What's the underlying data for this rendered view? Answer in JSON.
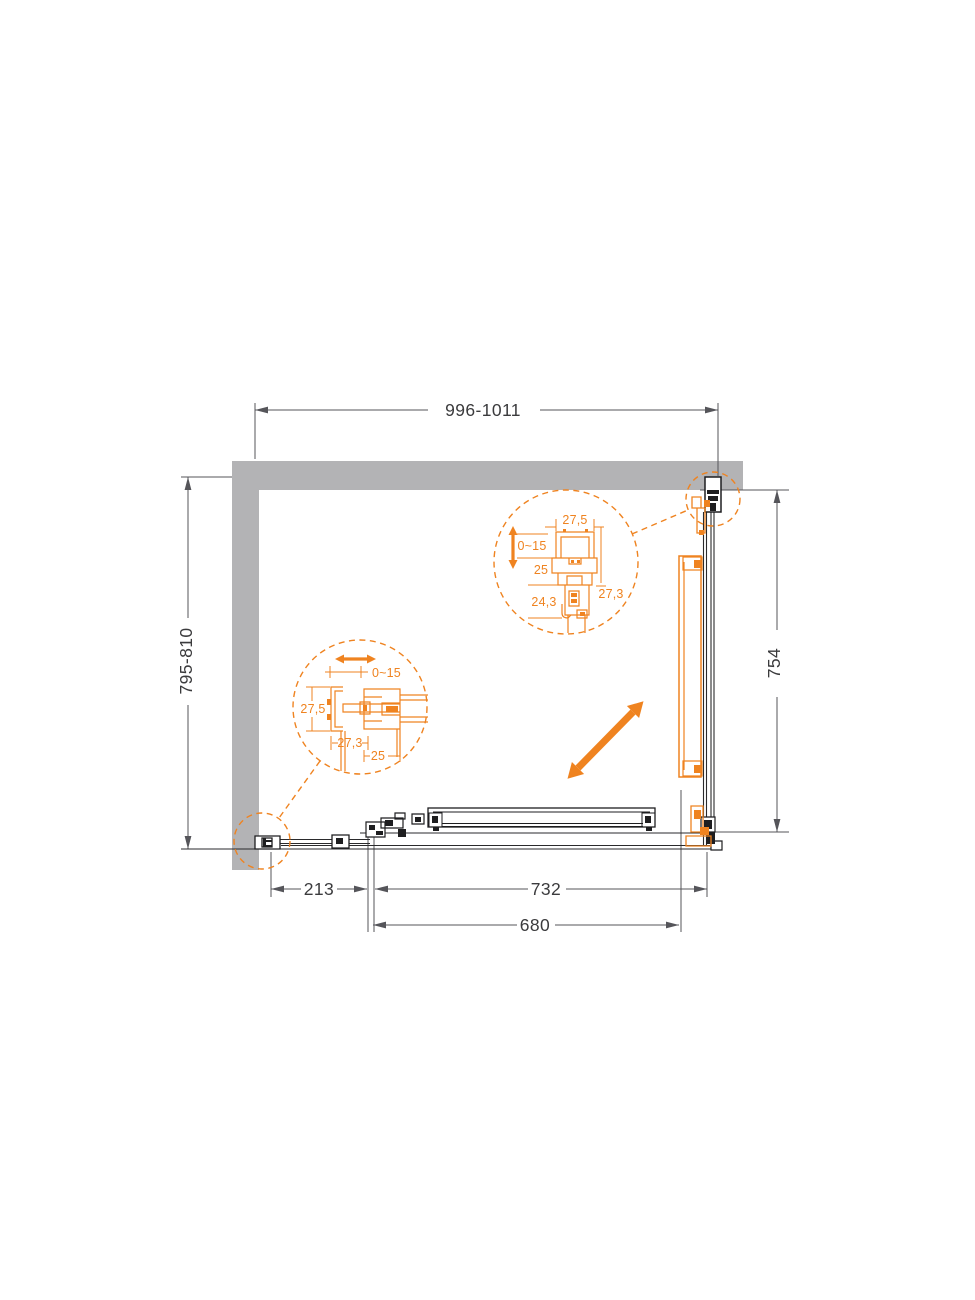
{
  "colors": {
    "accent_orange": "#EF8320",
    "wall_gray": "#B3B3B5",
    "drawing_line": "#1E1E20",
    "dimension_line": "#55555A",
    "dimension_text": "#3B3B3D"
  },
  "plan": {
    "dimensions": {
      "top_width": "996-1011",
      "left_depth": "795-810",
      "right_panel_height": "754",
      "bottom_wall_offset": "213",
      "bottom_opening_width": "732",
      "bottom_door_width": "680"
    }
  },
  "detail_top": {
    "profile_width": "27,5",
    "adjustment_range": "0~15",
    "mid_depth": "25",
    "side_depth": "27,3",
    "lower_depth": "24,3"
  },
  "detail_left": {
    "adjustment_range": "0~15",
    "profile_height": "27,5",
    "profile_depth": "27,3",
    "pocket_depth": "25"
  },
  "icons": {
    "diagonal_double_arrow": "⤢",
    "vertical_adjust_arrow": "↕",
    "horizontal_adjust_arrow": "↔"
  }
}
